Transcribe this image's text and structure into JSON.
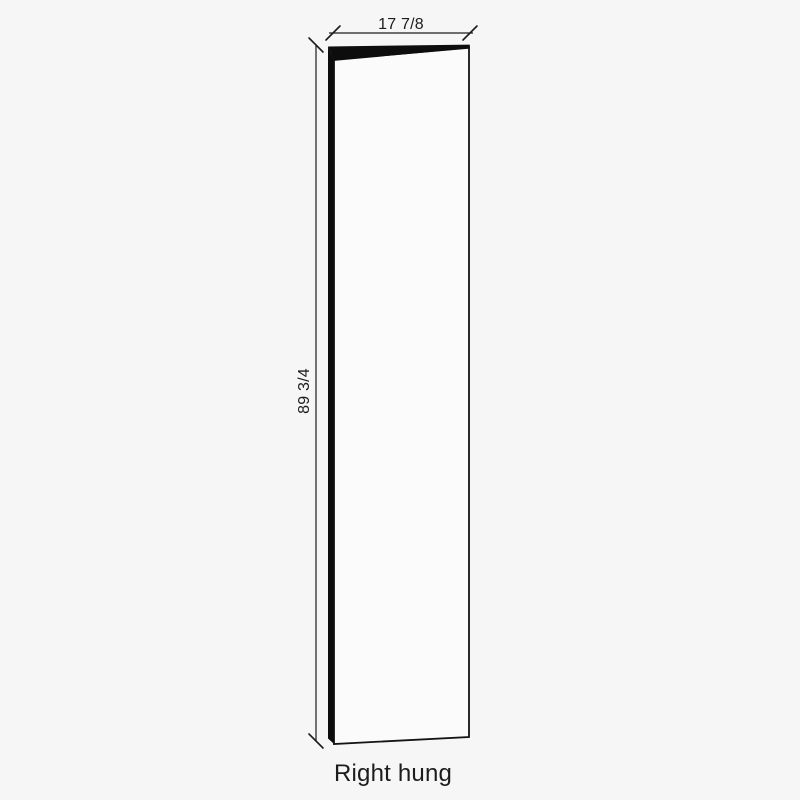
{
  "diagram": {
    "type": "door-panel-dimension-drawing",
    "width_dimension": "17 7/8",
    "height_dimension": "89 3/4",
    "caption": "Right hung",
    "colors": {
      "background": "#f5f6f5",
      "panel_fill": "#fbfbfb",
      "edge_fill": "#0d0d0d",
      "line": "#1c1c1c"
    }
  }
}
